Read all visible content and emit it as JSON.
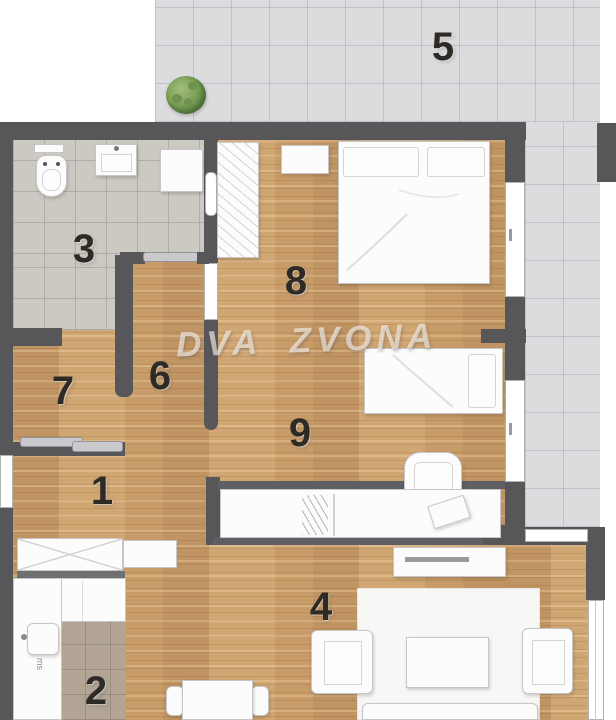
{
  "plan": {
    "watermark": "DVA ZVONA",
    "rooms": {
      "hallway": {
        "label": "1"
      },
      "kitchen": {
        "label": "2"
      },
      "bathroom": {
        "label": "3"
      },
      "living_room": {
        "label": "4"
      },
      "terrace": {
        "label": "5"
      },
      "hall": {
        "label": "6"
      },
      "room": {
        "label": "7"
      },
      "bedroom_large": {
        "label": "8"
      },
      "bedroom_small": {
        "label": "9"
      }
    },
    "kitchen_appliance_label": "ms",
    "colors": {
      "wall": "#57575a",
      "wood_floor": "#c99e6c",
      "terrace_tile": "#dcdcde",
      "bathroom_tile": "#ccc9c3",
      "kitchen_tile": "#b2a595",
      "furniture": "#fcfcfc",
      "label_text": "#2e2a25",
      "watermark_text": "#f8f6f2",
      "plant_green": "#6f9450"
    }
  }
}
